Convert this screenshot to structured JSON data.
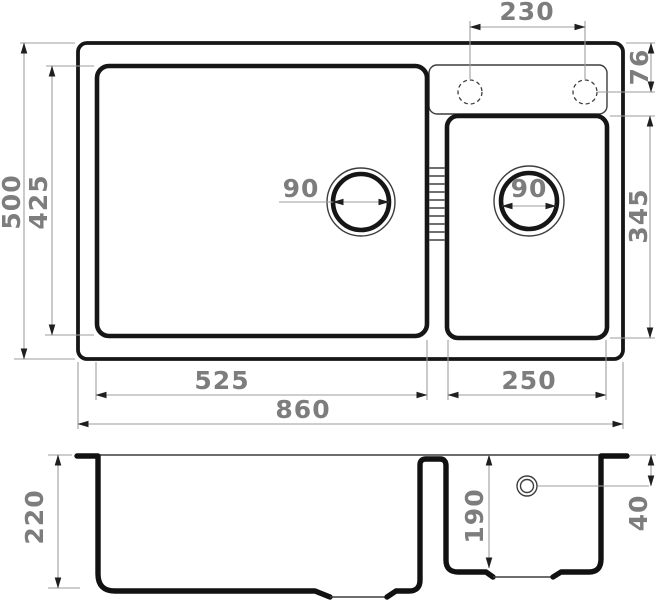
{
  "colors": {
    "background": "#ffffff",
    "outline": "#161616",
    "thin_line": "#3d3d3d",
    "dimension_line": "#9e9e9e",
    "dimension_text": "#7d7d7d"
  },
  "top_view": {
    "faucet_hole_spacing": "230",
    "faucet_hole_offset": "76",
    "overall_depth": "500",
    "main_bowl_depth": "425",
    "small_bowl_depth": "345",
    "main_drain_diameter": "90",
    "small_drain_diameter": "90",
    "main_bowl_width": "525",
    "small_bowl_width": "250",
    "overall_width": "860"
  },
  "section_view": {
    "main_bowl_height": "220",
    "small_bowl_height": "190",
    "overflow_offset": "40"
  }
}
